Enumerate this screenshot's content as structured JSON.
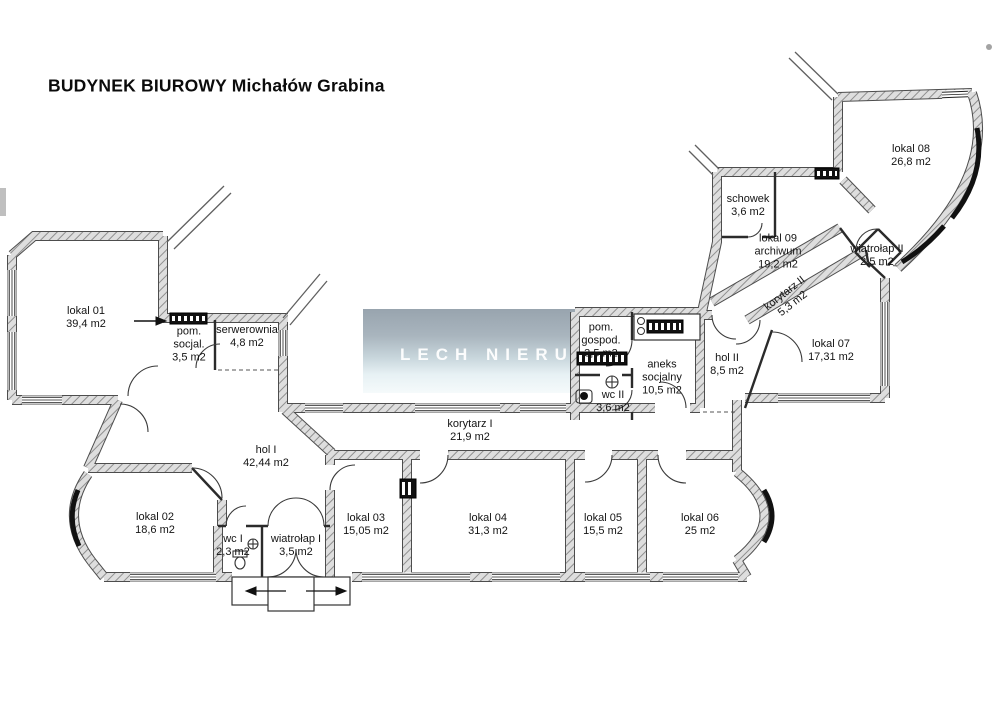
{
  "title": "BUDYNEK BIUROWY Michałów Grabina",
  "watermark": {
    "text": "LECH NIERUCHOMOŚCI"
  },
  "rooms": [
    {
      "id": "lokal-01",
      "name": "lokal 01",
      "area": "39,4 m2"
    },
    {
      "id": "pom-socjal",
      "name": "pom. socjal.",
      "area": "3,5 m2"
    },
    {
      "id": "serwerownia",
      "name": "serwerownia",
      "area": "4,8 m2"
    },
    {
      "id": "hol-1",
      "name": "hol I",
      "area": "42,44 m2"
    },
    {
      "id": "lokal-02",
      "name": "lokal 02",
      "area": "18,6 m2"
    },
    {
      "id": "wc-1",
      "name": "wc I",
      "area": "2,3 m2"
    },
    {
      "id": "wiatrolap-1",
      "name": "wiatrołap I",
      "area": "3,5 m2"
    },
    {
      "id": "lokal-03",
      "name": "lokal 03",
      "area": "15,05 m2"
    },
    {
      "id": "lokal-04",
      "name": "lokal 04",
      "area": "31,3 m2"
    },
    {
      "id": "lokal-05",
      "name": "lokal 05",
      "area": "15,5 m2"
    },
    {
      "id": "lokal-06",
      "name": "lokal 06",
      "area": "25 m2"
    },
    {
      "id": "korytarz-1",
      "name": "korytarz I",
      "area": "21,9 m2"
    },
    {
      "id": "pom-gospod",
      "name": "pom. gospod.",
      "area": "3,5 m2"
    },
    {
      "id": "wc-2",
      "name": "wc II",
      "area": "3,6 m2"
    },
    {
      "id": "aneks-socjalny",
      "name": "aneks socjalny",
      "area": "10,5 m2"
    },
    {
      "id": "hol-2",
      "name": "hol II",
      "area": "8,5 m2"
    },
    {
      "id": "lokal-07",
      "name": "lokal 07",
      "area": "17,31 m2"
    },
    {
      "id": "korytarz-2",
      "name": "korytarz II",
      "area": "5,3 m2"
    },
    {
      "id": "lokal-09",
      "name": "lokal 09 archiwum",
      "area": "19,2 m2"
    },
    {
      "id": "schowek",
      "name": "schowek",
      "area": "3,6 m2"
    },
    {
      "id": "lokal-08",
      "name": "lokal 08",
      "area": "26,8 m2"
    },
    {
      "id": "wiatrolap-2",
      "name": "wiatrołap II",
      "area": "2,5 m2"
    }
  ]
}
